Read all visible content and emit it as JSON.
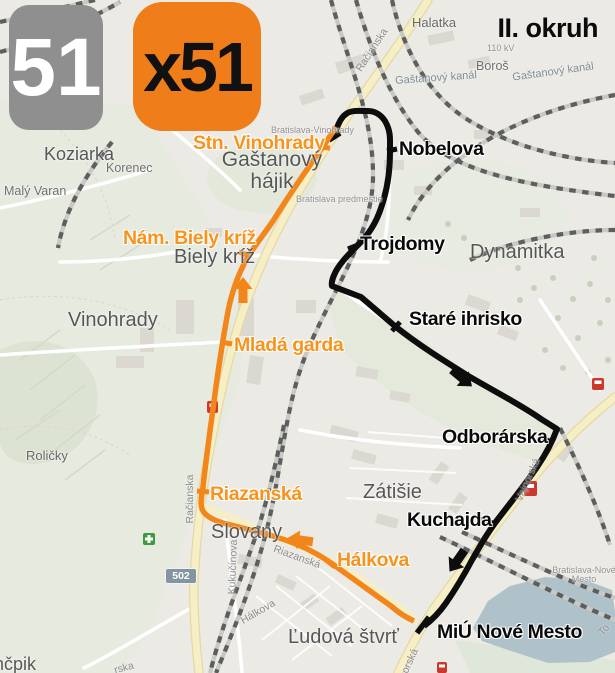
{
  "header": {
    "badge_51": "51",
    "badge_x51": "x51",
    "title": "II. okruh"
  },
  "road_badge": {
    "number": "502"
  },
  "routes": {
    "orange": {
      "color": "#F2861B",
      "label_color": "#F7941D",
      "stops": {
        "stn_vinohrady": "Stn. Vinohrady",
        "nam_biely_kriz": "Nám. Biely kríž",
        "mlada_garda": "Mladá garda",
        "riazanska": "Riazanská",
        "halkova": "Hálkova"
      }
    },
    "black": {
      "color": "#0D0D0D",
      "stops": {
        "nobelova": "Nobelova",
        "trojdomy": "Trojdomy",
        "stare_ihrisko": "Staré ihrisko",
        "odborarska": "Odborárska",
        "kuchajda": "Kuchajda",
        "miu_nove_mesto": "MiÚ Nové Mesto"
      }
    }
  },
  "map_labels": {
    "koziarka": "Koziarka",
    "korenec": "Korenec",
    "maly_varan": "Malý Varan",
    "halatka": "Halatka",
    "gastanovy_kanal_1": "Gaštanový kanál",
    "boros": "Boroš",
    "gastanovy_kanal_2": "Gaštanový kanál",
    "kv_110": "110 kV",
    "gastanovy_hajik": "Gaštanový hájik",
    "bratislava_vinohrady": "Bratislava-Vinohrady",
    "bratislava_predmestie": "Bratislava predmestie",
    "biely_kriz": "Biely kríž",
    "vinohrady": "Vinohrady",
    "dynamitka": "Dynamitka",
    "zatisie": "Zátišie",
    "slovany": "Slovany",
    "ludova_stvrt": "Ľudová štvrť",
    "bratislava_nove_mesto": "Bratislava-Nové Mesto",
    "rolicky": "Roličky",
    "ncpik_partial": "nčpik"
  },
  "street_labels": {
    "racianska_top": "Račianska",
    "racianska": "Račianska",
    "kukucinova": "Kukučínova",
    "riazanska": "Riazanská",
    "halkova": "Hálkova",
    "pionierska_partial": "rska",
    "vajnorska": "Vajnorská",
    "vajnorska_partial": "orská",
    "tomasikova_partial": "To"
  },
  "icons": {
    "red_station": "rail-station-icon",
    "green_pharmacy": "pharmacy-icon"
  }
}
